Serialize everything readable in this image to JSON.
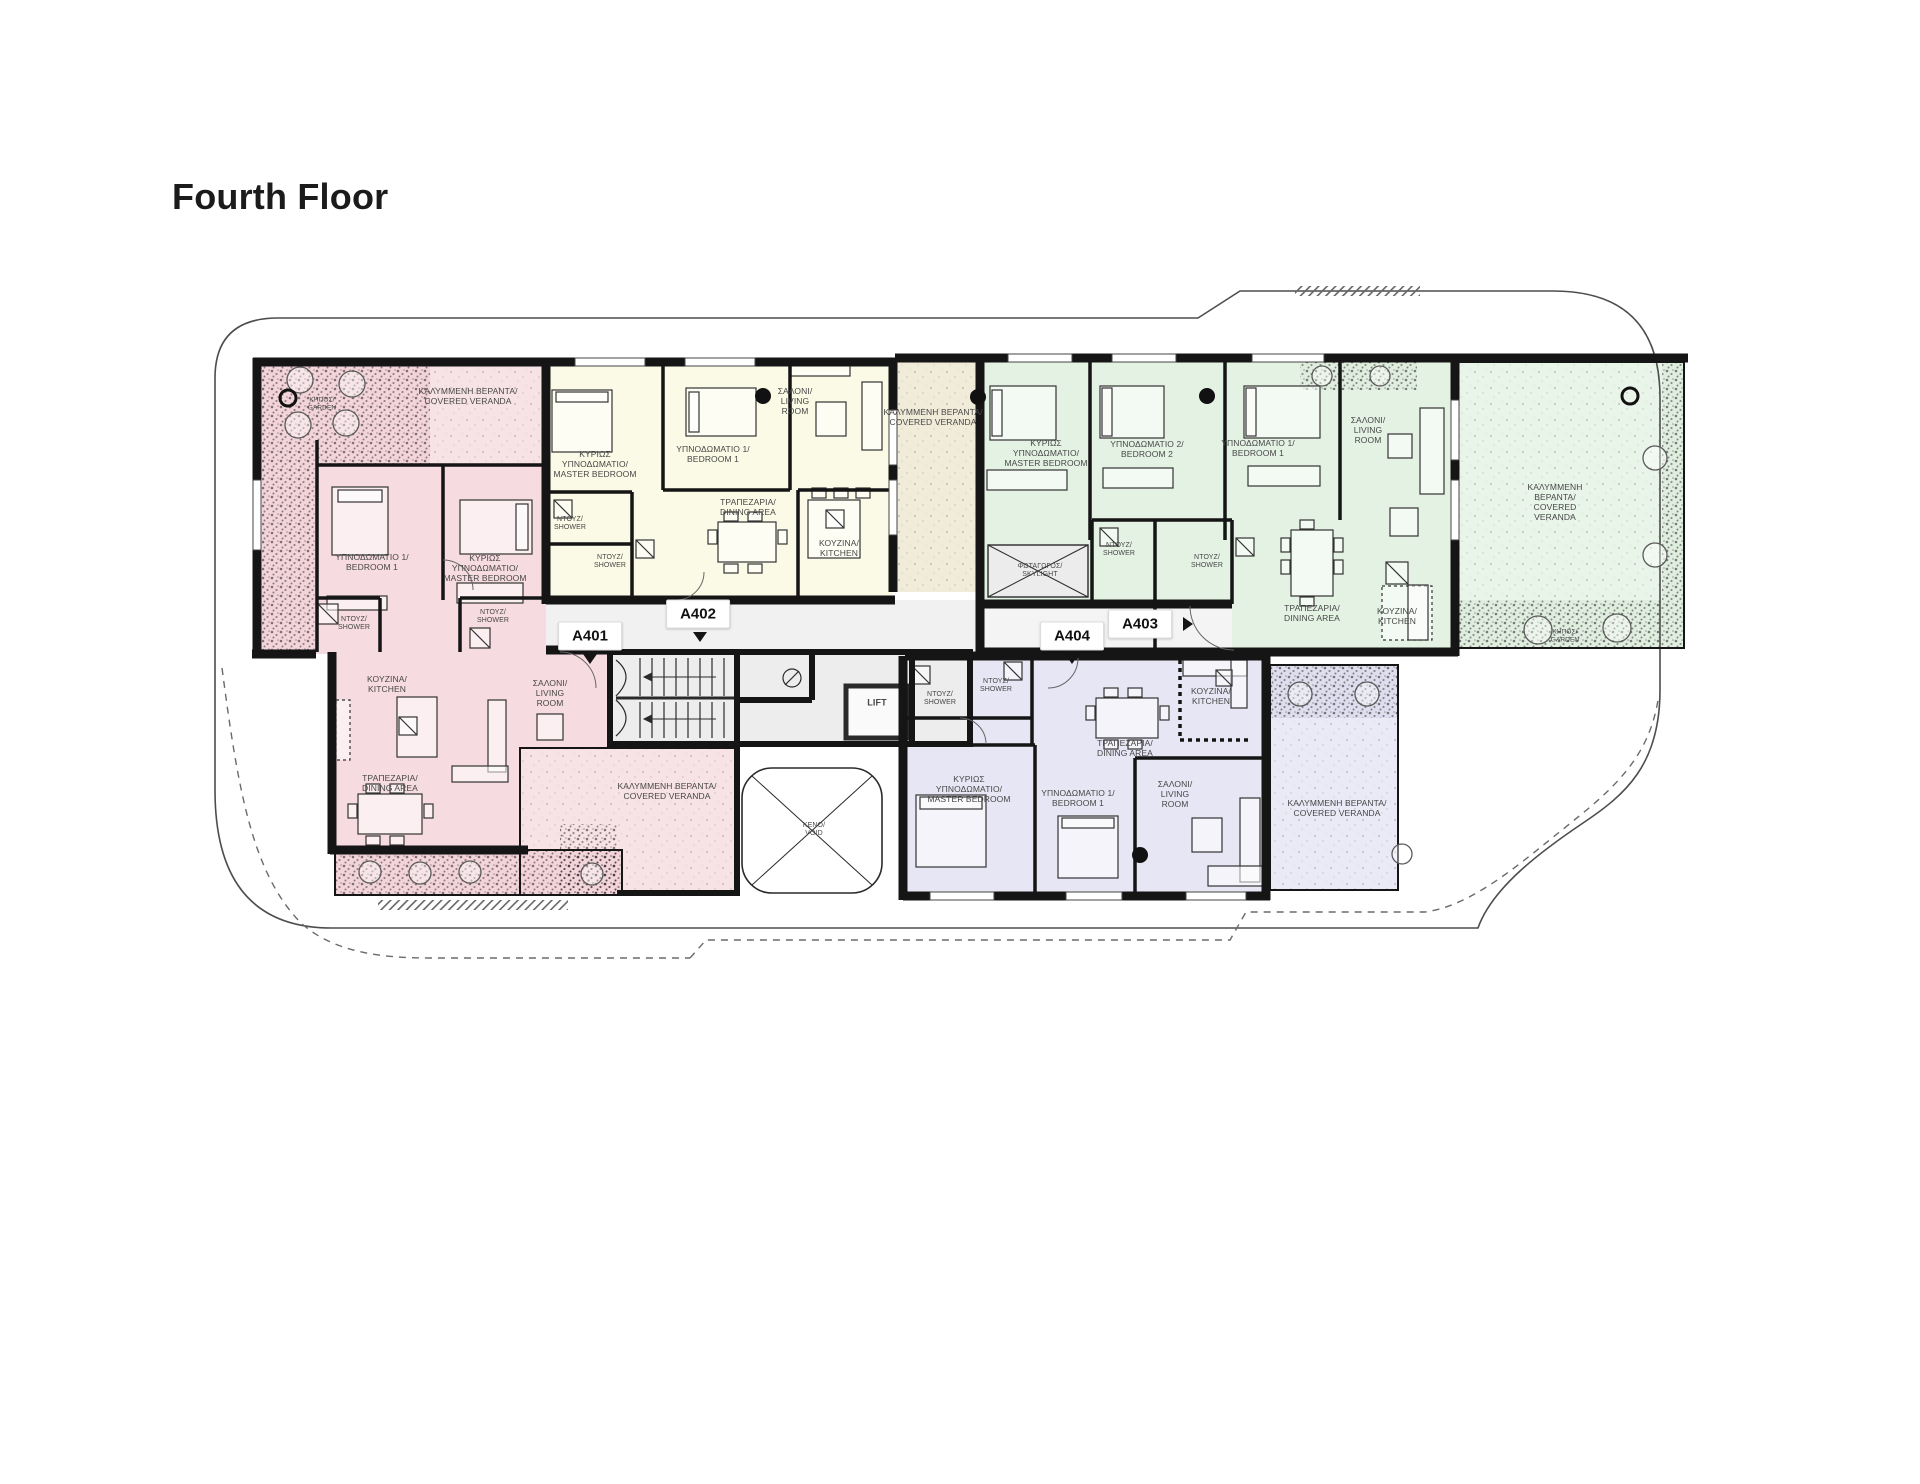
{
  "title": "Fourth Floor",
  "palette": {
    "unit_a401_pink": "#f6dbe0",
    "unit_a402_yellow": "#fafae6",
    "unit_a403_green": "#e4f2e4",
    "unit_a404_purple": "#e6e6f4",
    "veranda_tan": "#f0ecd9",
    "corridor_grey": "#f1f1f1",
    "wall_black": "#151515"
  },
  "units": [
    {
      "id": "A401",
      "color_name": "pink",
      "badge_x": 590,
      "badge_y": 636,
      "arrow": "down",
      "arrow_x": 590,
      "arrow_y": 659
    },
    {
      "id": "A402",
      "color_name": "yellow",
      "badge_x": 698,
      "badge_y": 614,
      "arrow": "down",
      "arrow_x": 700,
      "arrow_y": 637
    },
    {
      "id": "A403",
      "color_name": "green",
      "badge_x": 1140,
      "badge_y": 624,
      "arrow": "right",
      "arrow_x": 1188,
      "arrow_y": 624
    },
    {
      "id": "A404",
      "color_name": "purple",
      "badge_x": 1072,
      "badge_y": 636,
      "arrow": "down",
      "arrow_x": 1072,
      "arrow_y": 659
    }
  ],
  "labels": [
    {
      "name": "a401-covered-veranda-top",
      "text": "ΚΑΛΥΜΜΕΝΗ ΒΕΡΑΝΤΑ/\nCOVERED VERANDA",
      "x": 468,
      "y": 396
    },
    {
      "name": "a401-garden",
      "text": "ΚΗΠΟΣ/\nGARDEN",
      "x": 322,
      "y": 404,
      "size": 6.5
    },
    {
      "name": "a401-bedroom-1",
      "text": "ΥΠΝΟΔΩΜΑΤΙΟ 1/\nBEDROOM 1",
      "x": 372,
      "y": 562
    },
    {
      "name": "a401-master-bedroom",
      "text": "ΚΥΡΙΩΣ\nΥΠΝΟΔΩΜΑΤΙΟ/\nMASTER BEDROOM",
      "x": 485,
      "y": 568
    },
    {
      "name": "a401-shower-1",
      "text": "ΝΤΟΥΖ/\nSHOWER",
      "x": 354,
      "y": 624,
      "size": 7
    },
    {
      "name": "a401-shower-2",
      "text": "ΝΤΟΥΖ/\nSHOWER",
      "x": 493,
      "y": 617,
      "size": 7
    },
    {
      "name": "a401-kitchen",
      "text": "ΚΟΥΖΙΝΑ/\nKITCHEN",
      "x": 387,
      "y": 684
    },
    {
      "name": "a401-living-room",
      "text": "ΣΑΛΟΝΙ/\nLIVING\nROOM",
      "x": 550,
      "y": 693
    },
    {
      "name": "a401-dining-area",
      "text": "ΤΡΑΠΕΖΑΡΙΑ/\nDINING AREA",
      "x": 390,
      "y": 783
    },
    {
      "name": "a401-covered-veranda",
      "text": "ΚΑΛΥΜΜΕΝΗ ΒΕΡΑΝΤΑ/\nCOVERED VERANDA",
      "x": 667,
      "y": 791
    },
    {
      "name": "a402-master-bedroom",
      "text": "ΚΥΡΙΩΣ\nΥΠΝΟΔΩΜΑΤΙΟ/\nMASTER BEDROOM",
      "x": 595,
      "y": 464
    },
    {
      "name": "a402-bedroom-1",
      "text": "ΥΠΝΟΔΩΜΑΤΙΟ 1/\nBEDROOM 1",
      "x": 713,
      "y": 454
    },
    {
      "name": "a402-living-room",
      "text": "ΣΑΛΟΝΙ/\nLIVING\nROOM",
      "x": 795,
      "y": 401
    },
    {
      "name": "a402-dining-area",
      "text": "ΤΡΑΠΕΖΑΡΙΑ/\nDINING AREA",
      "x": 748,
      "y": 507
    },
    {
      "name": "a402-kitchen",
      "text": "ΚΟΥΖΙΝΑ/\nKITCHEN",
      "x": 839,
      "y": 548
    },
    {
      "name": "a402-shower-1",
      "text": "ΝΤΟΥΖ/\nSHOWER",
      "x": 570,
      "y": 524,
      "size": 7
    },
    {
      "name": "a402-shower-2",
      "text": "ΝΤΟΥΖ/\nSHOWER",
      "x": 610,
      "y": 562,
      "size": 7
    },
    {
      "name": "mid-covered-veranda",
      "text": "ΚΑΛΥΜΜΕΝΗ ΒΕΡΑΝΤΑ/\nCOVERED VERANDA",
      "x": 933,
      "y": 417
    },
    {
      "name": "a403-master-bedroom",
      "text": "ΚΥΡΙΩΣ\nΥΠΝΟΔΩΜΑΤΙΟ/\nMASTER BEDROOM",
      "x": 1046,
      "y": 453
    },
    {
      "name": "a403-bedroom-2",
      "text": "ΥΠΝΟΔΩΜΑΤΙΟ 2/\nBEDROOM 2",
      "x": 1147,
      "y": 449
    },
    {
      "name": "a403-bedroom-1",
      "text": "ΥΠΝΟΔΩΜΑΤΙΟ 1/\nBEDROOM 1",
      "x": 1258,
      "y": 448
    },
    {
      "name": "a403-living-room",
      "text": "ΣΑΛΟΝΙ/\nLIVING\nROOM",
      "x": 1368,
      "y": 430
    },
    {
      "name": "a403-skylight",
      "text": "ΦΩΤΑΓΩΓΟΣ/\nSKYLIGHT",
      "x": 1040,
      "y": 571,
      "size": 7
    },
    {
      "name": "a403-shower-1",
      "text": "ΝΤΟΥΖ/\nSHOWER",
      "x": 1119,
      "y": 550,
      "size": 7
    },
    {
      "name": "a403-shower-2",
      "text": "ΝΤΟΥΖ/\nSHOWER",
      "x": 1207,
      "y": 562,
      "size": 7
    },
    {
      "name": "a403-dining-area",
      "text": "ΤΡΑΠΕΖΑΡΙΑ/\nDINING AREA",
      "x": 1312,
      "y": 613
    },
    {
      "name": "a403-kitchen",
      "text": "ΚΟΥΖΙΝΑ/\nKITCHEN",
      "x": 1397,
      "y": 616
    },
    {
      "name": "a403-covered-veranda",
      "text": "ΚΑΛΥΜΜΕΝΗ\nΒΕΡΑΝΤΑ/\nCOVERED\nVERANDA",
      "x": 1555,
      "y": 502
    },
    {
      "name": "a403-garden",
      "text": "ΚΗΠΟΣ/\nGARDEN",
      "x": 1565,
      "y": 636,
      "size": 6.5
    },
    {
      "name": "a404-master-bedroom",
      "text": "ΚΥΡΙΩΣ\nΥΠΝΟΔΩΜΑΤΙΟ/\nMASTER BEDROOM",
      "x": 969,
      "y": 789
    },
    {
      "name": "a404-bedroom-1",
      "text": "ΥΠΝΟΔΩΜΑΤΙΟ 1/\nBEDROOM 1",
      "x": 1078,
      "y": 798
    },
    {
      "name": "a404-living-room",
      "text": "ΣΑΛΟΝΙ/\nLIVING\nROOM",
      "x": 1175,
      "y": 794
    },
    {
      "name": "a404-dining-area",
      "text": "ΤΡΑΠΕΖΑΡΙΑ/\nDINING AREA",
      "x": 1125,
      "y": 748
    },
    {
      "name": "a404-kitchen",
      "text": "ΚΟΥΖΙΝΑ/\nKITCHEN",
      "x": 1211,
      "y": 696
    },
    {
      "name": "a404-shower-1",
      "text": "ΝΤΟΥΖ/\nSHOWER",
      "x": 940,
      "y": 699,
      "size": 7
    },
    {
      "name": "a404-shower-2",
      "text": "ΝΤΟΥΖ/\nSHOWER",
      "x": 996,
      "y": 686,
      "size": 7
    },
    {
      "name": "a404-covered-veranda",
      "text": "ΚΑΛΥΜΜΕΝΗ ΒΕΡΑΝΤΑ/\nCOVERED VERANDA",
      "x": 1337,
      "y": 808
    },
    {
      "name": "lift",
      "text": "LIFT",
      "x": 877,
      "y": 703,
      "size": 9,
      "weight": 700
    },
    {
      "name": "void",
      "text": "ΚΕΝΟ/\nVOID",
      "x": 814,
      "y": 830,
      "size": 7
    }
  ]
}
